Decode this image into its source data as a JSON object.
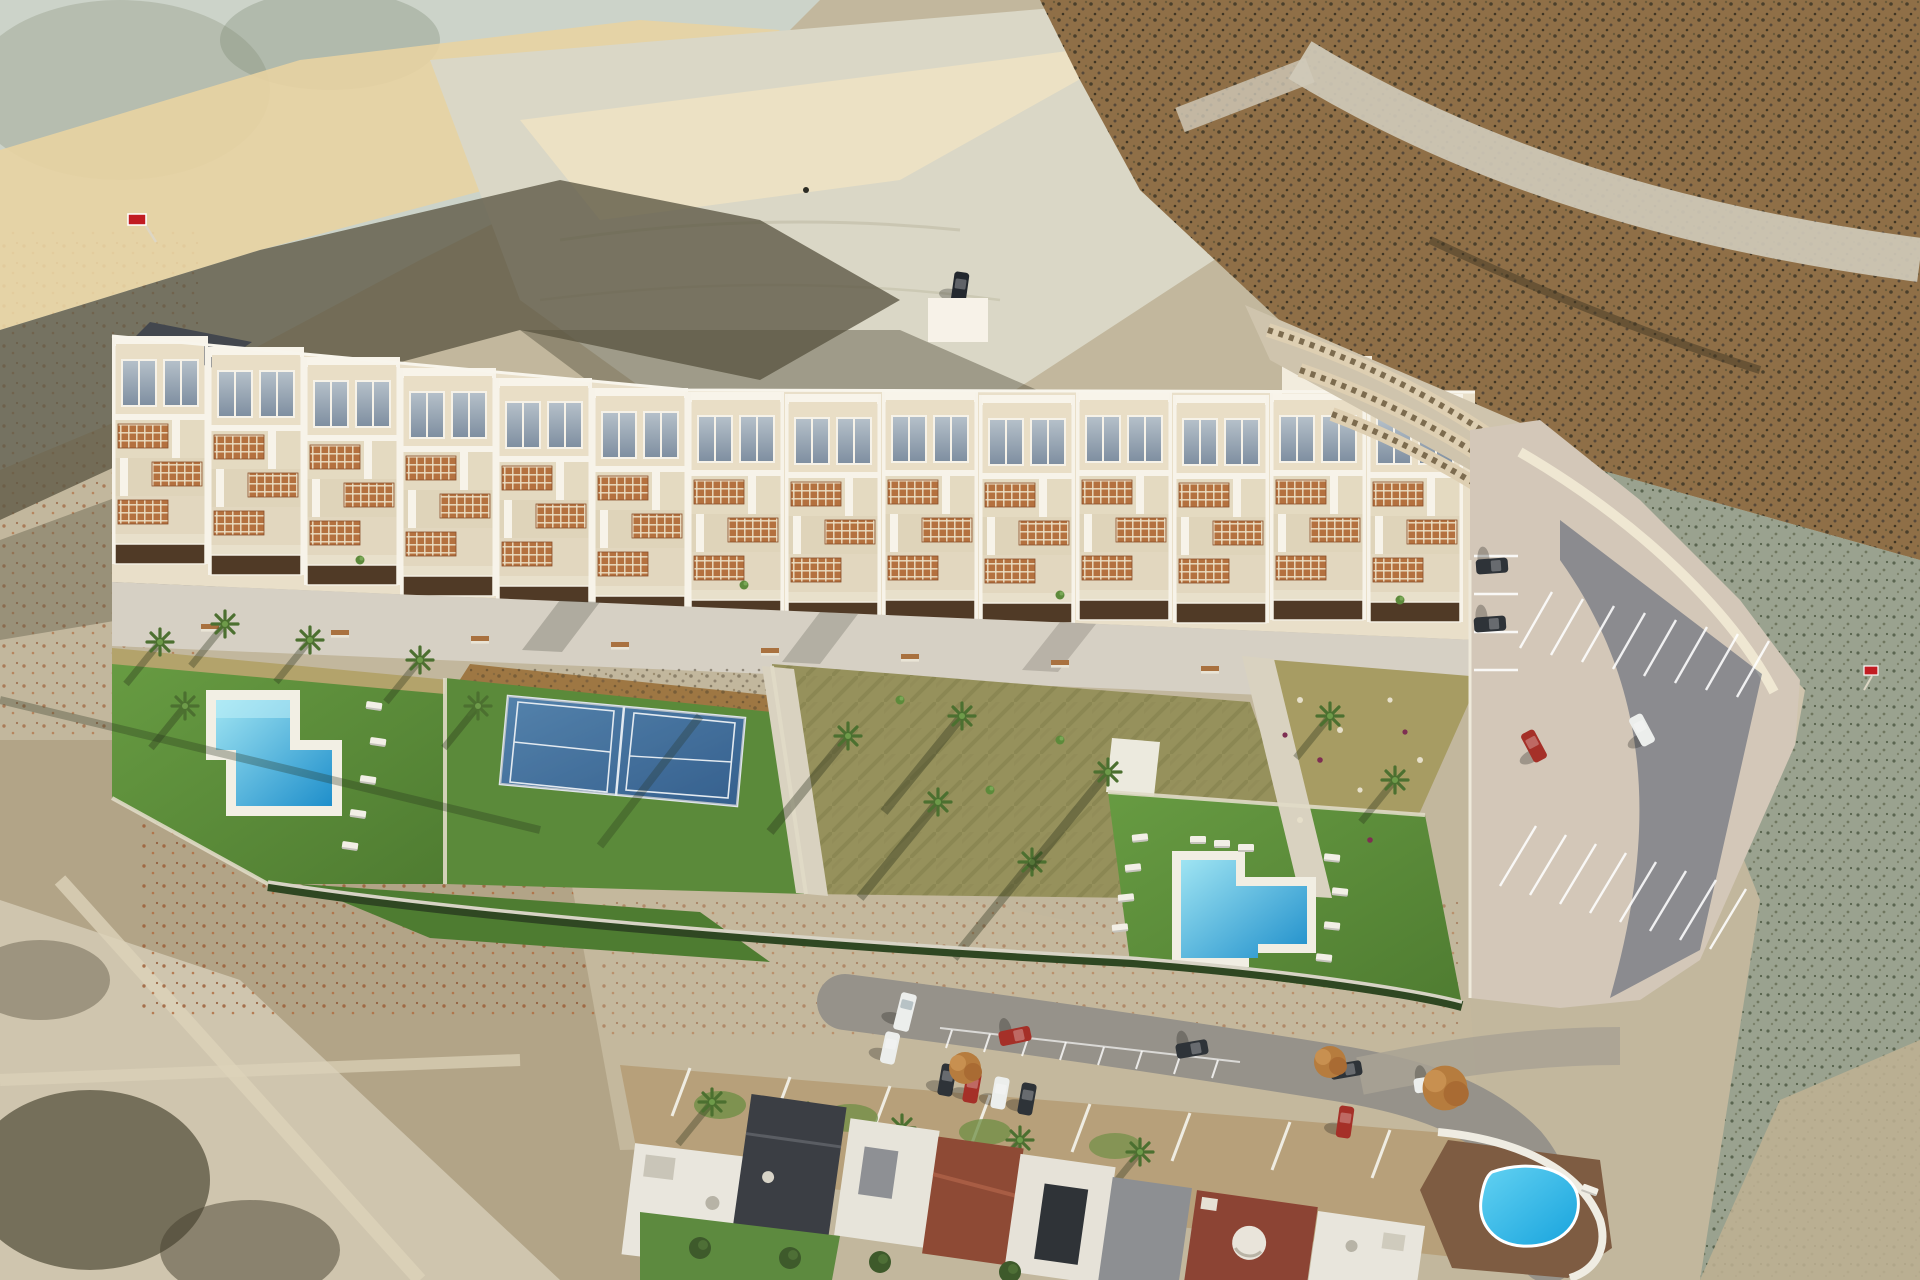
{
  "meta": {
    "scene": "aerial-drone-render-residential-development",
    "width_px": 1920,
    "height_px": 1280
  },
  "colors": {
    "terrain_base": "#c2b79d",
    "pale_slope": "#ccd3c9",
    "golden": "#e8d3a2",
    "plateau": "#dad7c6",
    "plateau_light": "#eee3c3",
    "ravine_shadow": "#5c5744",
    "scrub_brown": "#8f6f47",
    "right_scrub": "#9aa28f",
    "dirt_path": "#cfc9b9",
    "bottom_dirt": "#b2a487",
    "cleared_dirt": "#d2c9b2",
    "mid_dirt": "#c4b89d",
    "walkway": "#d6d0c4",
    "building_cream": "#e9dfc9",
    "building_white": "#f7f2e8",
    "roof_charcoal": "#43474e",
    "skylight_light": "#b6c1ca",
    "skylight_dark": "#7e8ea0",
    "pergola": "#b4713f",
    "planter": "#503a26",
    "lawn_light": "#679b42",
    "lawn_dark": "#4f7c31",
    "dry_lawn_left": "#b3a36b",
    "dry_lawn_center": "#96915c",
    "dry_lawn_right": "#a79c63",
    "mulch": "#9e7743",
    "pool_light": "#9fe4f2",
    "pool_deep": "#1f8fcb",
    "kidney_light": "#63d2f2",
    "kidney_deep": "#17a3dd",
    "court_light": "#6297c4",
    "court_dark": "#3a6a9d",
    "court_line": "#e3eaf0",
    "parking_asphalt": "#d3c7b8",
    "stall_line": "#ffffff",
    "street_asphalt": "#96928a",
    "yard_tan": "#b7a07a",
    "hedge_green": "#2f4722",
    "path_light": "#d9d2c0",
    "car_dark": "#2e3338",
    "car_white": "#eceeec",
    "car_red": "#a53028",
    "sign_red": "#c11c22",
    "dome_white": "#e9e4da"
  },
  "scene": {
    "development": {
      "unit_modules_visible": 14,
      "amenities": [
        "swimming-pool-left",
        "padel-courts",
        "gardens",
        "swimming-pool-right",
        "parking-lot",
        "promenade-walkway"
      ],
      "padel_courts": 2,
      "benches_on_walkway": 9
    },
    "pools": {
      "left_shape": "L-shaped",
      "right_shape": "L-shaped",
      "neighborhood_shape": "kidney"
    },
    "vehicles": {
      "parking_lot": 4,
      "street_and_bays": 10,
      "dirt_plateau": 1
    },
    "signs": {
      "red_flags": 2
    },
    "landscape": [
      "arid-badlands",
      "eroded-pale-slope",
      "golden-sunlit-ridge",
      "scrub-hillside",
      "dirt-tracks"
    ]
  }
}
